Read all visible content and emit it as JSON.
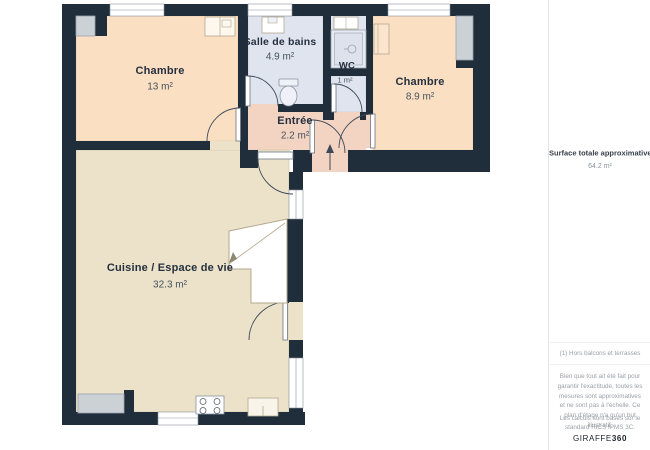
{
  "floorplan": {
    "rooms": [
      {
        "id": "chambre-1",
        "name": "Chambre",
        "area": "13 m²"
      },
      {
        "id": "salle-de-bains",
        "name": "Salle de bains",
        "area": "4.9 m²"
      },
      {
        "id": "wc",
        "name": "WC",
        "area": "1 m²"
      },
      {
        "id": "chambre-2",
        "name": "Chambre",
        "area": "8.9 m²"
      },
      {
        "id": "entree",
        "name": "Entrée",
        "area": "2.2 m²"
      },
      {
        "id": "cuisine",
        "name": "Cuisine / Espace de vie",
        "area": "32.3 m²"
      }
    ],
    "colors": {
      "wall": "#202d3b",
      "bedroom": "#fbdfc2",
      "bathroom": "#dfe4ef",
      "hall": "#f3d3c2",
      "living": "#ebe2c9"
    }
  },
  "sidebar": {
    "total_label": "Surface totale approximative",
    "total_note_ref": "(1)",
    "total_value": "64.2 m²",
    "footnote": "(1) Hors balcons et terrasses",
    "disclaimer": "Bien que tout ait été fait pour garantir l'exactitude, toutes les mesures sont approximatives et ne sont pas à l'échelle. Ce plan d'étage n'a qu'un but illustratif.",
    "standard_note": "Les calculs sont basés sur le standard RICS IPMS 3C.",
    "brand_name": "GIRAFFE",
    "brand_suffix": "360"
  }
}
